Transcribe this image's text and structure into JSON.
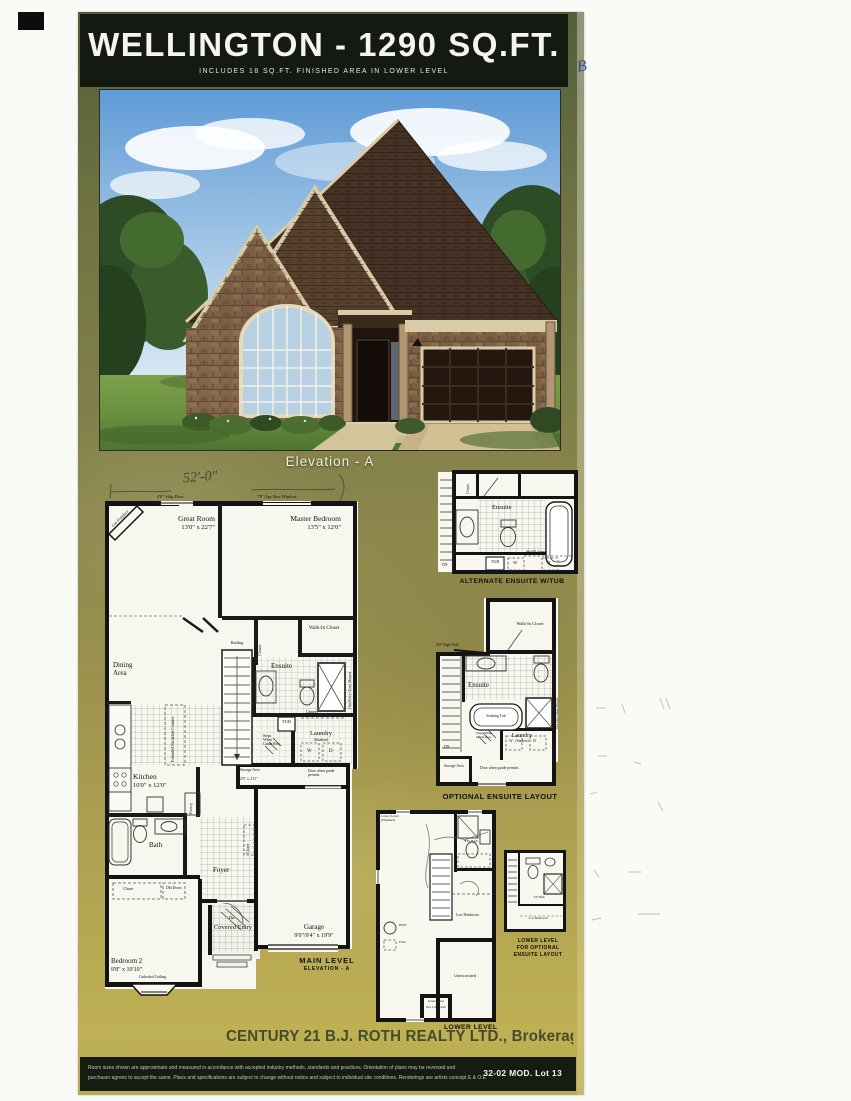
{
  "colors": {
    "sheet_green": "#8b8a4f",
    "band_black": "#141a11",
    "trim_cream": "#d9cda8"
  },
  "header": {
    "title": "WELLINGTON - 1290 SQ.FT.",
    "subtitle": "INCLUDES 18 SQ.FT. FINISHED AREA IN LOWER LEVEL"
  },
  "rendering": {
    "caption": "Elevation - A"
  },
  "main_plan": {
    "handwritten_width": "52'-0\"",
    "top_labels": {
      "sliding_door": "4'0\" Sldg Door",
      "box_window": "7'8\"/2pc Box Window"
    },
    "rooms": {
      "great_room": {
        "name": "Great Room",
        "dims": "13'0\" x 22'7\""
      },
      "master_bedroom": {
        "name": "Master Bedroom",
        "dims": "13'5\" x 12'0\""
      },
      "dining": {
        "name": "Dining Area"
      },
      "kitchen": {
        "name": "Kitchen",
        "dims": "10'0\" x 12'0\""
      },
      "bath": {
        "name": "Bath"
      },
      "foyer": {
        "name": "Foyer"
      },
      "bedroom2": {
        "name": "Bedroom 2",
        "dims": "9'8\" x 10'10\"",
        "note": "Cathedral Ceiling"
      },
      "covered_entry": {
        "name": "Covered Entry"
      },
      "garage": {
        "name": "Garage",
        "dims": "9'0\"/9'4\" x 19'9\""
      },
      "ensuite": {
        "name": "Ensuite"
      },
      "walk_in_closet": {
        "name": "Walk-In Closet"
      },
      "laundry": {
        "name": "Laundry",
        "note": "(Sunken)"
      },
      "storage": {
        "name": "Storage Area",
        "dims": "2'0\" x 4'11\""
      }
    },
    "fixtures": {
      "gas_fireplace": "Gas Fireplace",
      "railing": "Railing",
      "closet_master": "Closet",
      "shower": "One Piece Glass Shower",
      "tub": "TUB",
      "uppers": "Uppers",
      "washer": "W",
      "dryer": "D",
      "steps_grade": "Steps When Grade Req.",
      "ext_counter": "Extended Breakfast Counter",
      "pantry": "Pantry",
      "closet_foyer": "Closet",
      "closet_bed2": "Closet",
      "dbl_doors": "Dbl Doors",
      "grade_door": "Door when grade permits",
      "dn": "Dn"
    },
    "caption": {
      "line1": "MAIN LEVEL",
      "line2": "ELEVATION - A"
    }
  },
  "alt_ensuite_plan": {
    "caption": "ALTERNATE ENSUITE W/TUB",
    "labels": {
      "ensuite": "Ensuite",
      "closet": "Closet",
      "tub": "TUB",
      "shelf_uppers": "Shelf/Uppers",
      "washer": "W",
      "dryer": "D",
      "dn": "DN"
    }
  },
  "opt_ensuite_plan": {
    "caption": "OPTIONAL ENSUITE LAYOUT",
    "labels": {
      "high_wall": "4'0\" High Wall",
      "walk_in_closet": "Walk-In Closet",
      "ensuite": "Ensuite",
      "soaking_tub": "Soaking Tub",
      "shower": "One Piece Glass Shower",
      "dn": "DN",
      "steps_grade": "Steps When Grade Req.",
      "laundry": "Laundry",
      "laundry_note": "(Sunken)",
      "storage": "Storage Area",
      "grade_door": "Door when grade permits",
      "washer": "W",
      "dryer": "D"
    }
  },
  "lower_plan": {
    "caption": "LOWER LEVEL",
    "labels": {
      "area_title": "Lower Level (Finished)",
      "bath": "3 Pc Bath",
      "low_headroom": "Low Headroom",
      "hwt": "HWT",
      "furnace": "Furn",
      "unexcavated_main": "Unexcavated",
      "unexcavated_small": "Unexcavated",
      "cold_cellar": "Opt. Cold Cellar"
    }
  },
  "lower_opt_plan": {
    "caption_line1": "LOWER LEVEL",
    "caption_line2": "FOR OPTIONAL",
    "caption_line3": "ENSUITE LAYOUT",
    "labels": {
      "bath": "3 Pc Bath",
      "low_headroom": "Low Headroom"
    }
  },
  "footer": {
    "watermark": "CENTURY 21 B.J. ROTH REALTY LTD., Brokerage",
    "disclaimer_line1": "Room sizes shown are approximate and measured in accordance with accepted industry methods, standards and practices. Orientation of plans may be reversed and",
    "disclaimer_line2": "purchaser agrees to accept the same. Plans and specifications are subject to change without notice and subject to individual site conditions. Renderings are artists concept E & O.E",
    "lot_label": "32-02 MOD. Lot 13"
  },
  "annotations": {
    "pen_note": "B"
  }
}
